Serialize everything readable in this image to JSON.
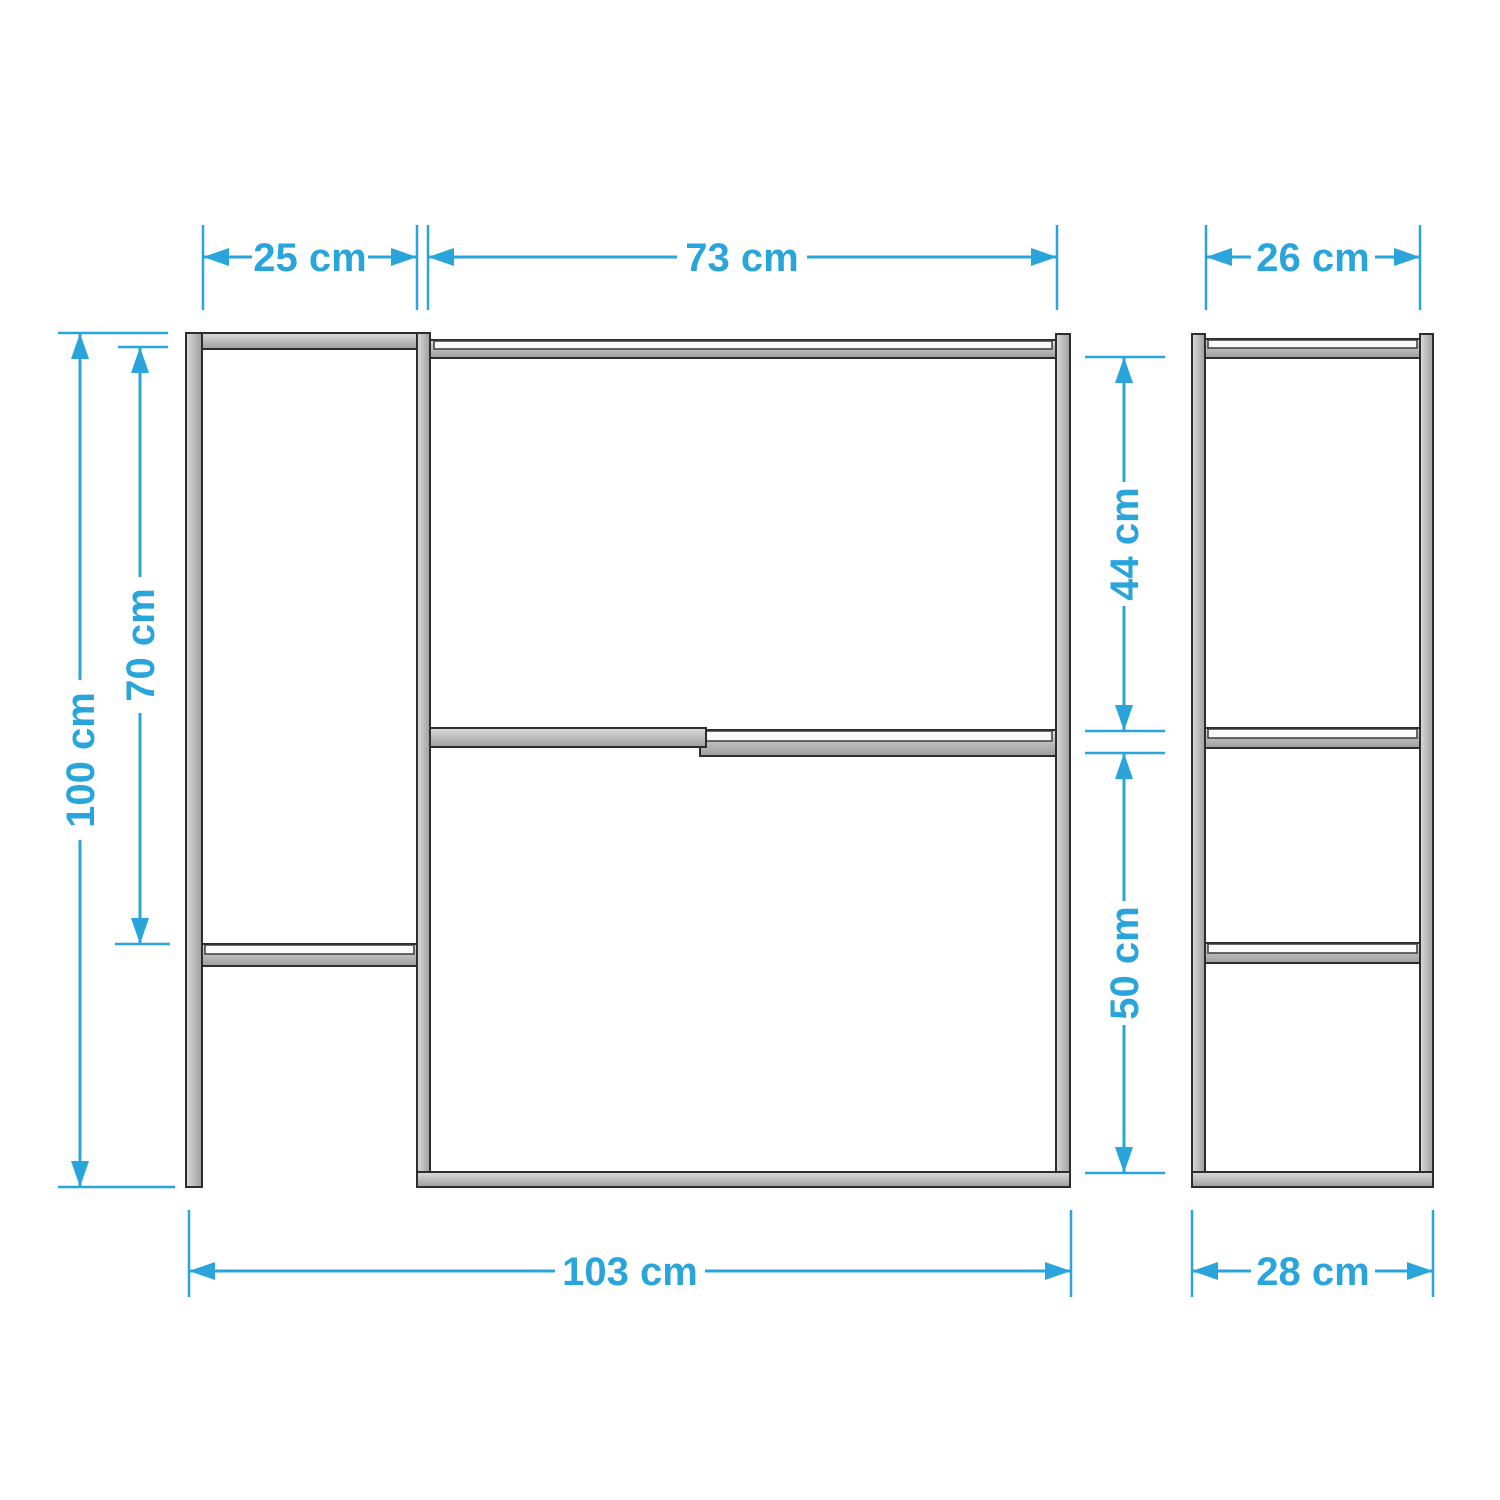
{
  "diagram": {
    "kind": "furniture dimension drawing",
    "unit": "cm",
    "views": {
      "front": "front view",
      "side": "side view"
    }
  },
  "dimensions": {
    "top_left_width": "25 cm",
    "top_main_width": "73 cm",
    "side_top_width": "26 cm",
    "overall_height": "100 cm",
    "left_shelf_height": "70 cm",
    "upper_section_height": "44 cm",
    "lower_section_height": "50 cm",
    "overall_width": "103 cm",
    "side_depth": "28 cm"
  },
  "colors": {
    "dimension_accent": "#29a5db",
    "frame_fill": "#c4c4c4",
    "frame_outline": "#2d2d2d",
    "frame_highlight": "#fafafa",
    "background": "#ffffff"
  }
}
